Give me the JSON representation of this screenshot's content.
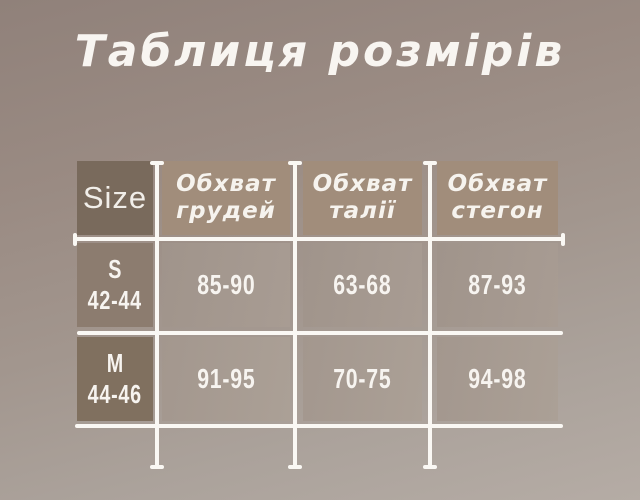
{
  "title": "Таблиця розмірів",
  "table": {
    "size_header": "Size",
    "columns": [
      {
        "line1": "Обхват",
        "line2": "грудей"
      },
      {
        "line1": "Обхват",
        "line2": "талії"
      },
      {
        "line1": "Обхват",
        "line2": "стегон"
      }
    ],
    "rows": [
      {
        "size": "S",
        "size_range": "42-44",
        "chest": "85-90",
        "waist": "63-68",
        "hips": "87-93"
      },
      {
        "size": "M",
        "size_range": "44-46",
        "chest": "91-95",
        "waist": "70-75",
        "hips": "94-98"
      }
    ]
  },
  "chart_data": {
    "type": "table",
    "title": "Таблиця розмірів",
    "columns": [
      "Size",
      "Обхват грудей",
      "Обхват талії",
      "Обхват стегон"
    ],
    "rows": [
      [
        "S 42-44",
        "85-90",
        "63-68",
        "87-93"
      ],
      [
        "M 44-46",
        "91-95",
        "70-75",
        "94-98"
      ]
    ]
  },
  "colors": {
    "background_top": "#90817a",
    "background_bottom": "#b5aca5",
    "size_header_bg": "#796a5c",
    "header_bg": "#a18d7b",
    "row1_size_bg": "#8c7c6f",
    "row2_size_bg": "#80705f",
    "grid_line": "#faf8f4",
    "text": "#f7f4f0"
  }
}
